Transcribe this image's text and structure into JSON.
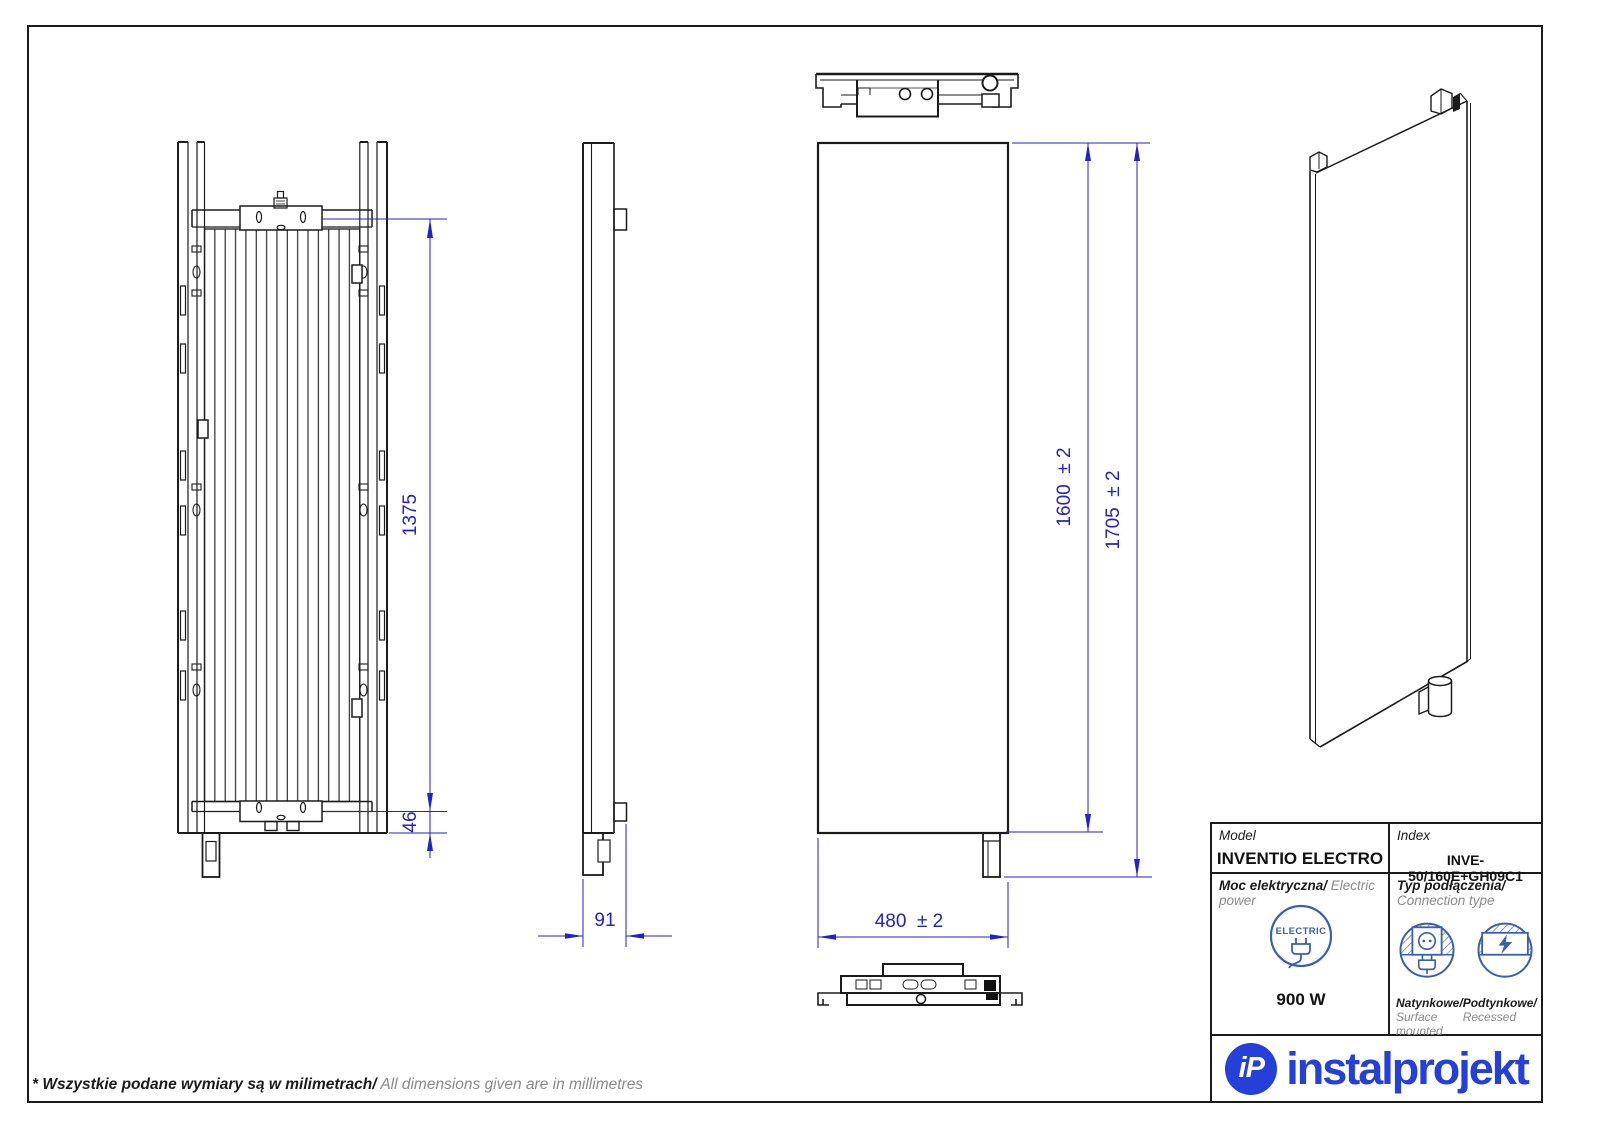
{
  "page": {
    "footer_note_pl": "* Wszystkie podane wymiary są w milimetrach/",
    "footer_note_en": " All dimensions given are in millimetres"
  },
  "dimensions": {
    "back_panel_height": "1375",
    "bottom_bracket_offset": "46",
    "depth": "91",
    "panel_height": "1600  ± 2",
    "total_height": "1705  ± 2",
    "width": "480  ± 2"
  },
  "title_block": {
    "model_label": "Model",
    "model_value": "INVENTIO ELECTRO",
    "index_label": "Index",
    "index_value": "INVE-50/160E+GH09C1",
    "power_label_pl": "Moc elektryczna/",
    "power_label_en": " Electric power",
    "power_value": "900 W",
    "electric_badge": "ELECTRIC",
    "connection_label_pl": "Typ podłączenia/",
    "connection_label_en": "Connection type",
    "surface_label_pl": "Natynkowe/",
    "surface_label_en": "Surface mounted",
    "recessed_label_pl": "Podtynkowe/",
    "recessed_label_en": "Recessed"
  },
  "logo": {
    "monogram": "iP",
    "wordmark": "instalprojekt"
  },
  "colors": {
    "line": "#1b1b1b",
    "dimension": "#2222c8",
    "icon_blue": "#3a60ad",
    "brand_blue": "#2440d8"
  }
}
